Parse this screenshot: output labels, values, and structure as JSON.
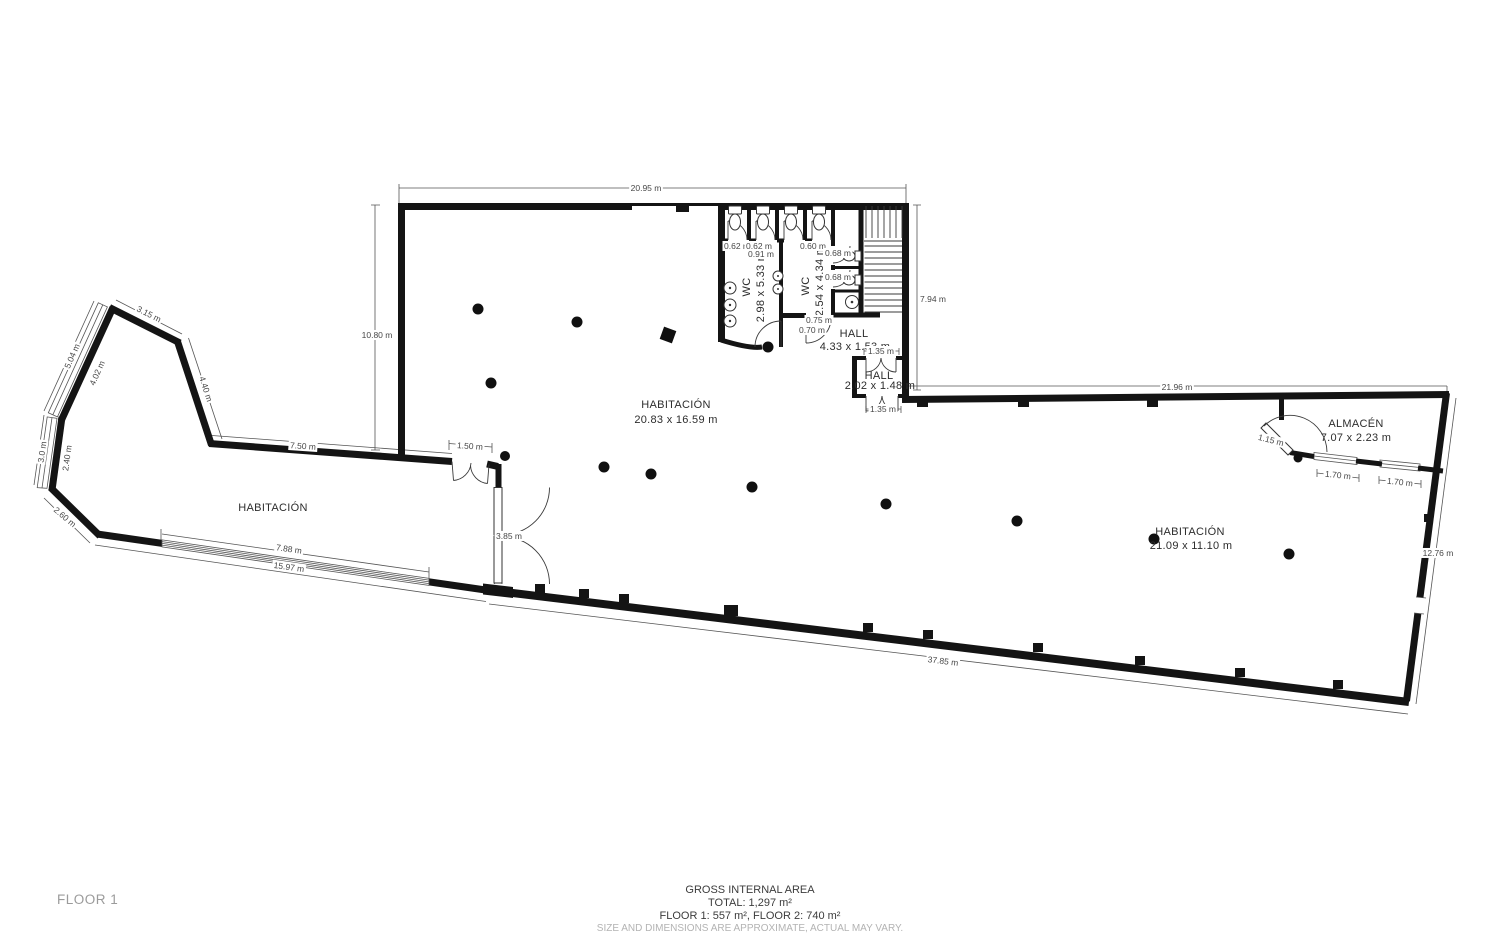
{
  "floor_selector": {
    "label": "FLOOR 1"
  },
  "footer": {
    "line1": "GROSS INTERNAL AREA",
    "line2": "TOTAL: 1,297 m²",
    "line3": "FLOOR 1: 557 m², FLOOR 2: 740 m²",
    "disclaimer": "SIZE AND DIMENSIONS ARE APPROXIMATE, ACTUAL MAY VARY."
  },
  "colors": {
    "wall": "#141414",
    "thin_line": "#555555",
    "dim_text": "#474747",
    "room_text": "#2d2d2d",
    "muted_text": "#9b9b9b",
    "column_fill": "#101010",
    "background": "#ffffff"
  },
  "plan": {
    "rooms": [
      {
        "name": "room-label-left-habitacion",
        "text": "HABITACIÓN",
        "x": 273,
        "y": 507,
        "rot": 0,
        "size": 10.5
      },
      {
        "name": "room-label-main-habitacion",
        "text": "HABITACIÓN",
        "x": 676,
        "y": 404,
        "rot": 0,
        "size": 11
      },
      {
        "name": "room-dims-main-habitacion",
        "text": "20.83 x 16.59 m",
        "x": 676,
        "y": 419,
        "rot": 0,
        "size": 11
      },
      {
        "name": "room-label-right-habitacion",
        "text": "HABITACIÓN",
        "x": 1190,
        "y": 531,
        "rot": 0,
        "size": 10.5
      },
      {
        "name": "room-dims-right-habitacion",
        "text": "21.09 x 11.10 m",
        "x": 1191,
        "y": 545,
        "rot": 0,
        "size": 10.5
      },
      {
        "name": "room-label-almacen",
        "text": "ALMACÉN",
        "x": 1356,
        "y": 423,
        "rot": 0,
        "size": 10
      },
      {
        "name": "room-dims-almacen",
        "text": "7.07 x 2.23 m",
        "x": 1356,
        "y": 437,
        "rot": 0,
        "size": 10
      },
      {
        "name": "room-label-wc1",
        "text": "WC",
        "x": 746,
        "y": 287,
        "rot": -90,
        "size": 10
      },
      {
        "name": "room-dims-wc1",
        "text": "2.98 x 5.33 m",
        "x": 760,
        "y": 287,
        "rot": -90,
        "size": 9.5
      },
      {
        "name": "room-label-wc2",
        "text": "WC",
        "x": 805,
        "y": 286,
        "rot": -90,
        "size": 10
      },
      {
        "name": "room-dims-wc2",
        "text": "2.54 x 4.34 m",
        "x": 819,
        "y": 281,
        "rot": -90,
        "size": 9.5
      },
      {
        "name": "room-label-hall",
        "text": "HALL",
        "x": 854,
        "y": 333,
        "rot": 0,
        "size": 10
      },
      {
        "name": "room-dims-hall",
        "text": "4.33 x 1.53 m",
        "x": 855,
        "y": 346,
        "rot": 0,
        "size": 10
      },
      {
        "name": "room-label-hall2",
        "text": "HALL",
        "x": 879,
        "y": 375,
        "rot": 0,
        "size": 8
      },
      {
        "name": "room-dims-hall2",
        "text": "2.02 x 1.48 m",
        "x": 880,
        "y": 385,
        "rot": 0,
        "size": 7.5
      }
    ],
    "dims": [
      {
        "name": "dim-top-width",
        "text": "20.95 m",
        "x": 646,
        "y": 188,
        "rot": 0,
        "size": 8.5
      },
      {
        "name": "dim-left-height",
        "text": "10.80 m",
        "x": 377,
        "y": 335,
        "rot": 0,
        "size": 8.5
      },
      {
        "name": "dim-right-upper",
        "text": "7.94 m",
        "x": 933,
        "y": 299,
        "rot": 0,
        "size": 8.5
      },
      {
        "name": "dim-wing-top",
        "text": "21.96 m",
        "x": 1177,
        "y": 387,
        "rot": 0,
        "size": 8.5
      },
      {
        "name": "dim-right-lower",
        "text": "12.76 m",
        "x": 1438,
        "y": 553,
        "rot": 0,
        "size": 8.5
      },
      {
        "name": "dim-bottom",
        "text": "37.85 m",
        "x": 943,
        "y": 661,
        "rot": 7,
        "size": 8.5
      },
      {
        "name": "dim-wing-bottom",
        "text": "15.97 m",
        "x": 289,
        "y": 567,
        "rot": 8,
        "size": 8.5
      },
      {
        "name": "dim-window-788",
        "text": "7.88 m",
        "x": 289,
        "y": 549,
        "rot": 8,
        "size": 8.5
      },
      {
        "name": "dim-750",
        "text": "7.50 m",
        "x": 303,
        "y": 446,
        "rot": 4,
        "size": 8.5
      },
      {
        "name": "dim-315",
        "text": "3.15 m",
        "x": 149,
        "y": 314,
        "rot": 27,
        "size": 8.5
      },
      {
        "name": "dim-504",
        "text": "5.04 m",
        "x": 72,
        "y": 356,
        "rot": -66,
        "size": 8.5
      },
      {
        "name": "dim-402",
        "text": "4.02 m",
        "x": 97,
        "y": 373,
        "rot": -66,
        "size": 8.5
      },
      {
        "name": "dim-440",
        "text": "4.40 m",
        "x": 206,
        "y": 389,
        "rot": 72,
        "size": 8.5
      },
      {
        "name": "dim-30",
        "text": "3.0 m",
        "x": 42,
        "y": 452,
        "rot": -82,
        "size": 8.5
      },
      {
        "name": "dim-240",
        "text": "2.40 m",
        "x": 67,
        "y": 458,
        "rot": -82,
        "size": 8.5
      },
      {
        "name": "dim-260",
        "text": "2.60 m",
        "x": 65,
        "y": 517,
        "rot": 40,
        "size": 8.5
      },
      {
        "name": "dim-150",
        "text": "1.50 m",
        "x": 470,
        "y": 446,
        "rot": 4,
        "size": 8
      },
      {
        "name": "dim-385",
        "text": "3.85 m",
        "x": 509,
        "y": 536,
        "rot": 0,
        "size": 8
      },
      {
        "name": "dim-135-top",
        "text": "1.35 m",
        "x": 881,
        "y": 351,
        "rot": 0,
        "size": 7.5
      },
      {
        "name": "dim-135-bottom",
        "text": "1.35 m",
        "x": 883,
        "y": 409,
        "rot": 0,
        "size": 7.5
      },
      {
        "name": "dim-062-a",
        "text": "0.62 m",
        "x": 737,
        "y": 246,
        "rot": 0,
        "size": 6.5
      },
      {
        "name": "dim-062-b",
        "text": "0.62 m",
        "x": 759,
        "y": 246,
        "rot": 0,
        "size": 6.5
      },
      {
        "name": "dim-091",
        "text": "0.91 m",
        "x": 761,
        "y": 254,
        "rot": 0,
        "size": 6.5
      },
      {
        "name": "dim-060",
        "text": "0.60 m",
        "x": 813,
        "y": 246,
        "rot": 0,
        "size": 6.5
      },
      {
        "name": "dim-068-a",
        "text": "0.68 m",
        "x": 838,
        "y": 253,
        "rot": 0,
        "size": 6.5
      },
      {
        "name": "dim-068-b",
        "text": "0.68 m",
        "x": 838,
        "y": 277,
        "rot": 0,
        "size": 6.5
      },
      {
        "name": "dim-075",
        "text": "0.75 m",
        "x": 819,
        "y": 320,
        "rot": 0,
        "size": 7
      },
      {
        "name": "dim-070",
        "text": "0.70 m",
        "x": 812,
        "y": 330,
        "rot": 0,
        "size": 7
      },
      {
        "name": "dim-115",
        "text": "1.15 m",
        "x": 1271,
        "y": 440,
        "rot": 14,
        "size": 7.5
      },
      {
        "name": "dim-170-a",
        "text": "1.70 m",
        "x": 1338,
        "y": 475,
        "rot": 6,
        "size": 7.5
      },
      {
        "name": "dim-170-b",
        "text": "1.70 m",
        "x": 1400,
        "y": 482,
        "rot": 6,
        "size": 7.5
      }
    ],
    "columns": [
      {
        "x": 478,
        "y": 309,
        "r": 5.5
      },
      {
        "x": 577,
        "y": 322,
        "r": 5.5
      },
      {
        "x": 491,
        "y": 383,
        "r": 5.5
      },
      {
        "x": 768,
        "y": 347,
        "r": 5.5
      },
      {
        "x": 505,
        "y": 456,
        "r": 5
      },
      {
        "x": 604,
        "y": 467,
        "r": 5.5
      },
      {
        "x": 651,
        "y": 474,
        "r": 5.5
      },
      {
        "x": 752,
        "y": 487,
        "r": 5.5
      },
      {
        "x": 886,
        "y": 504,
        "r": 5.5
      },
      {
        "x": 1017,
        "y": 521,
        "r": 5.5
      },
      {
        "x": 1154,
        "y": 539,
        "r": 5.5
      },
      {
        "x": 1289,
        "y": 554,
        "r": 5.5
      },
      {
        "x": 1298,
        "y": 458,
        "r": 4.5
      },
      {
        "x": 668,
        "y": 335,
        "shape": "square",
        "s": 13,
        "rot": 20
      }
    ]
  }
}
